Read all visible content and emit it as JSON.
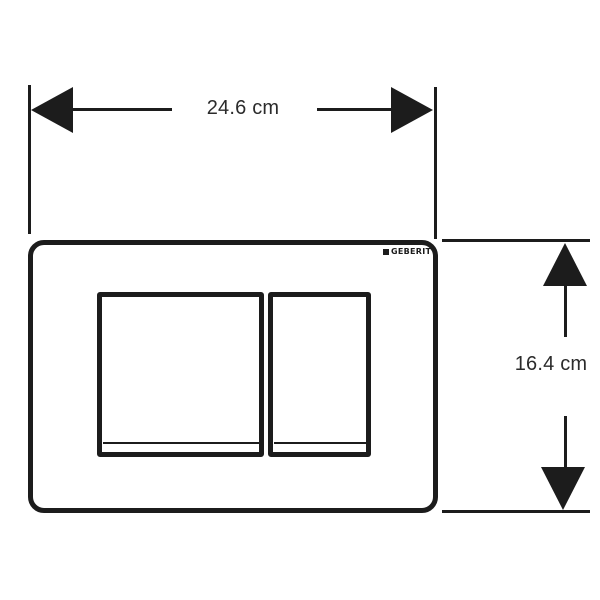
{
  "diagram": {
    "width_dimension": {
      "label": "24.6 cm"
    },
    "height_dimension": {
      "label": "16.4 cm"
    },
    "plate": {
      "brand_logo": "GEBERIT"
    },
    "colors": {
      "ink": "#1c1c1c",
      "label_text": "#2b2b2b",
      "background": "#ffffff"
    }
  }
}
